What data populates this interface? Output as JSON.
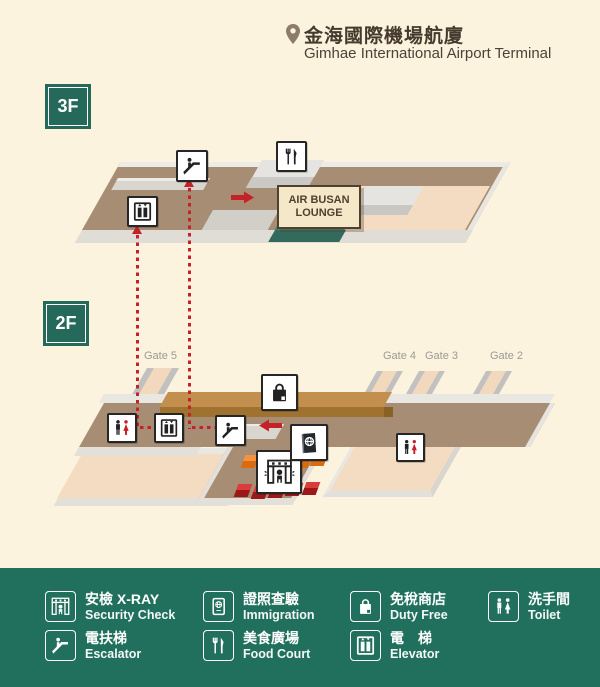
{
  "header": {
    "title_zh": "金海國際機場航廈",
    "title_en": "Gimhae International Airport Terminal"
  },
  "floors": {
    "f3": "3F",
    "f2": "2F"
  },
  "map": {
    "lounge_line1": "AIR BUSAN",
    "lounge_line2": "LOUNGE",
    "gates": [
      "Gate 5",
      "Gate 4",
      "Gate 3",
      "Gate 2"
    ]
  },
  "legend": {
    "items": [
      {
        "zh": "安檢 X-RAY",
        "en": "Security Check",
        "icon": "security-check-icon"
      },
      {
        "zh": "證照查驗",
        "en": "Immigration",
        "icon": "immigration-icon"
      },
      {
        "zh": "免稅商店",
        "en": "Duty Free",
        "icon": "duty-free-icon"
      },
      {
        "zh": "洗手間",
        "en": "Toilet",
        "icon": "toilet-icon"
      },
      {
        "zh": "電扶梯",
        "en": "Escalator",
        "icon": "escalator-icon"
      },
      {
        "zh": "美食廣場",
        "en": "Food Court",
        "icon": "food-court-icon"
      },
      {
        "zh": "電　梯",
        "en": "Elevator",
        "icon": "elevator-icon"
      }
    ]
  },
  "colors": {
    "background": "#fbf3de",
    "legend_green": "#20705d",
    "badge_green": "#25695a",
    "floor_brown": "#a78d74",
    "floor_peach": "#f3dcc2",
    "dutyfree_bar": "#c28f4f",
    "lounge_teal": "#3f7d6d",
    "route_red": "#c42128",
    "orange_block": "#f59140",
    "red_block": "#da3c3c"
  }
}
